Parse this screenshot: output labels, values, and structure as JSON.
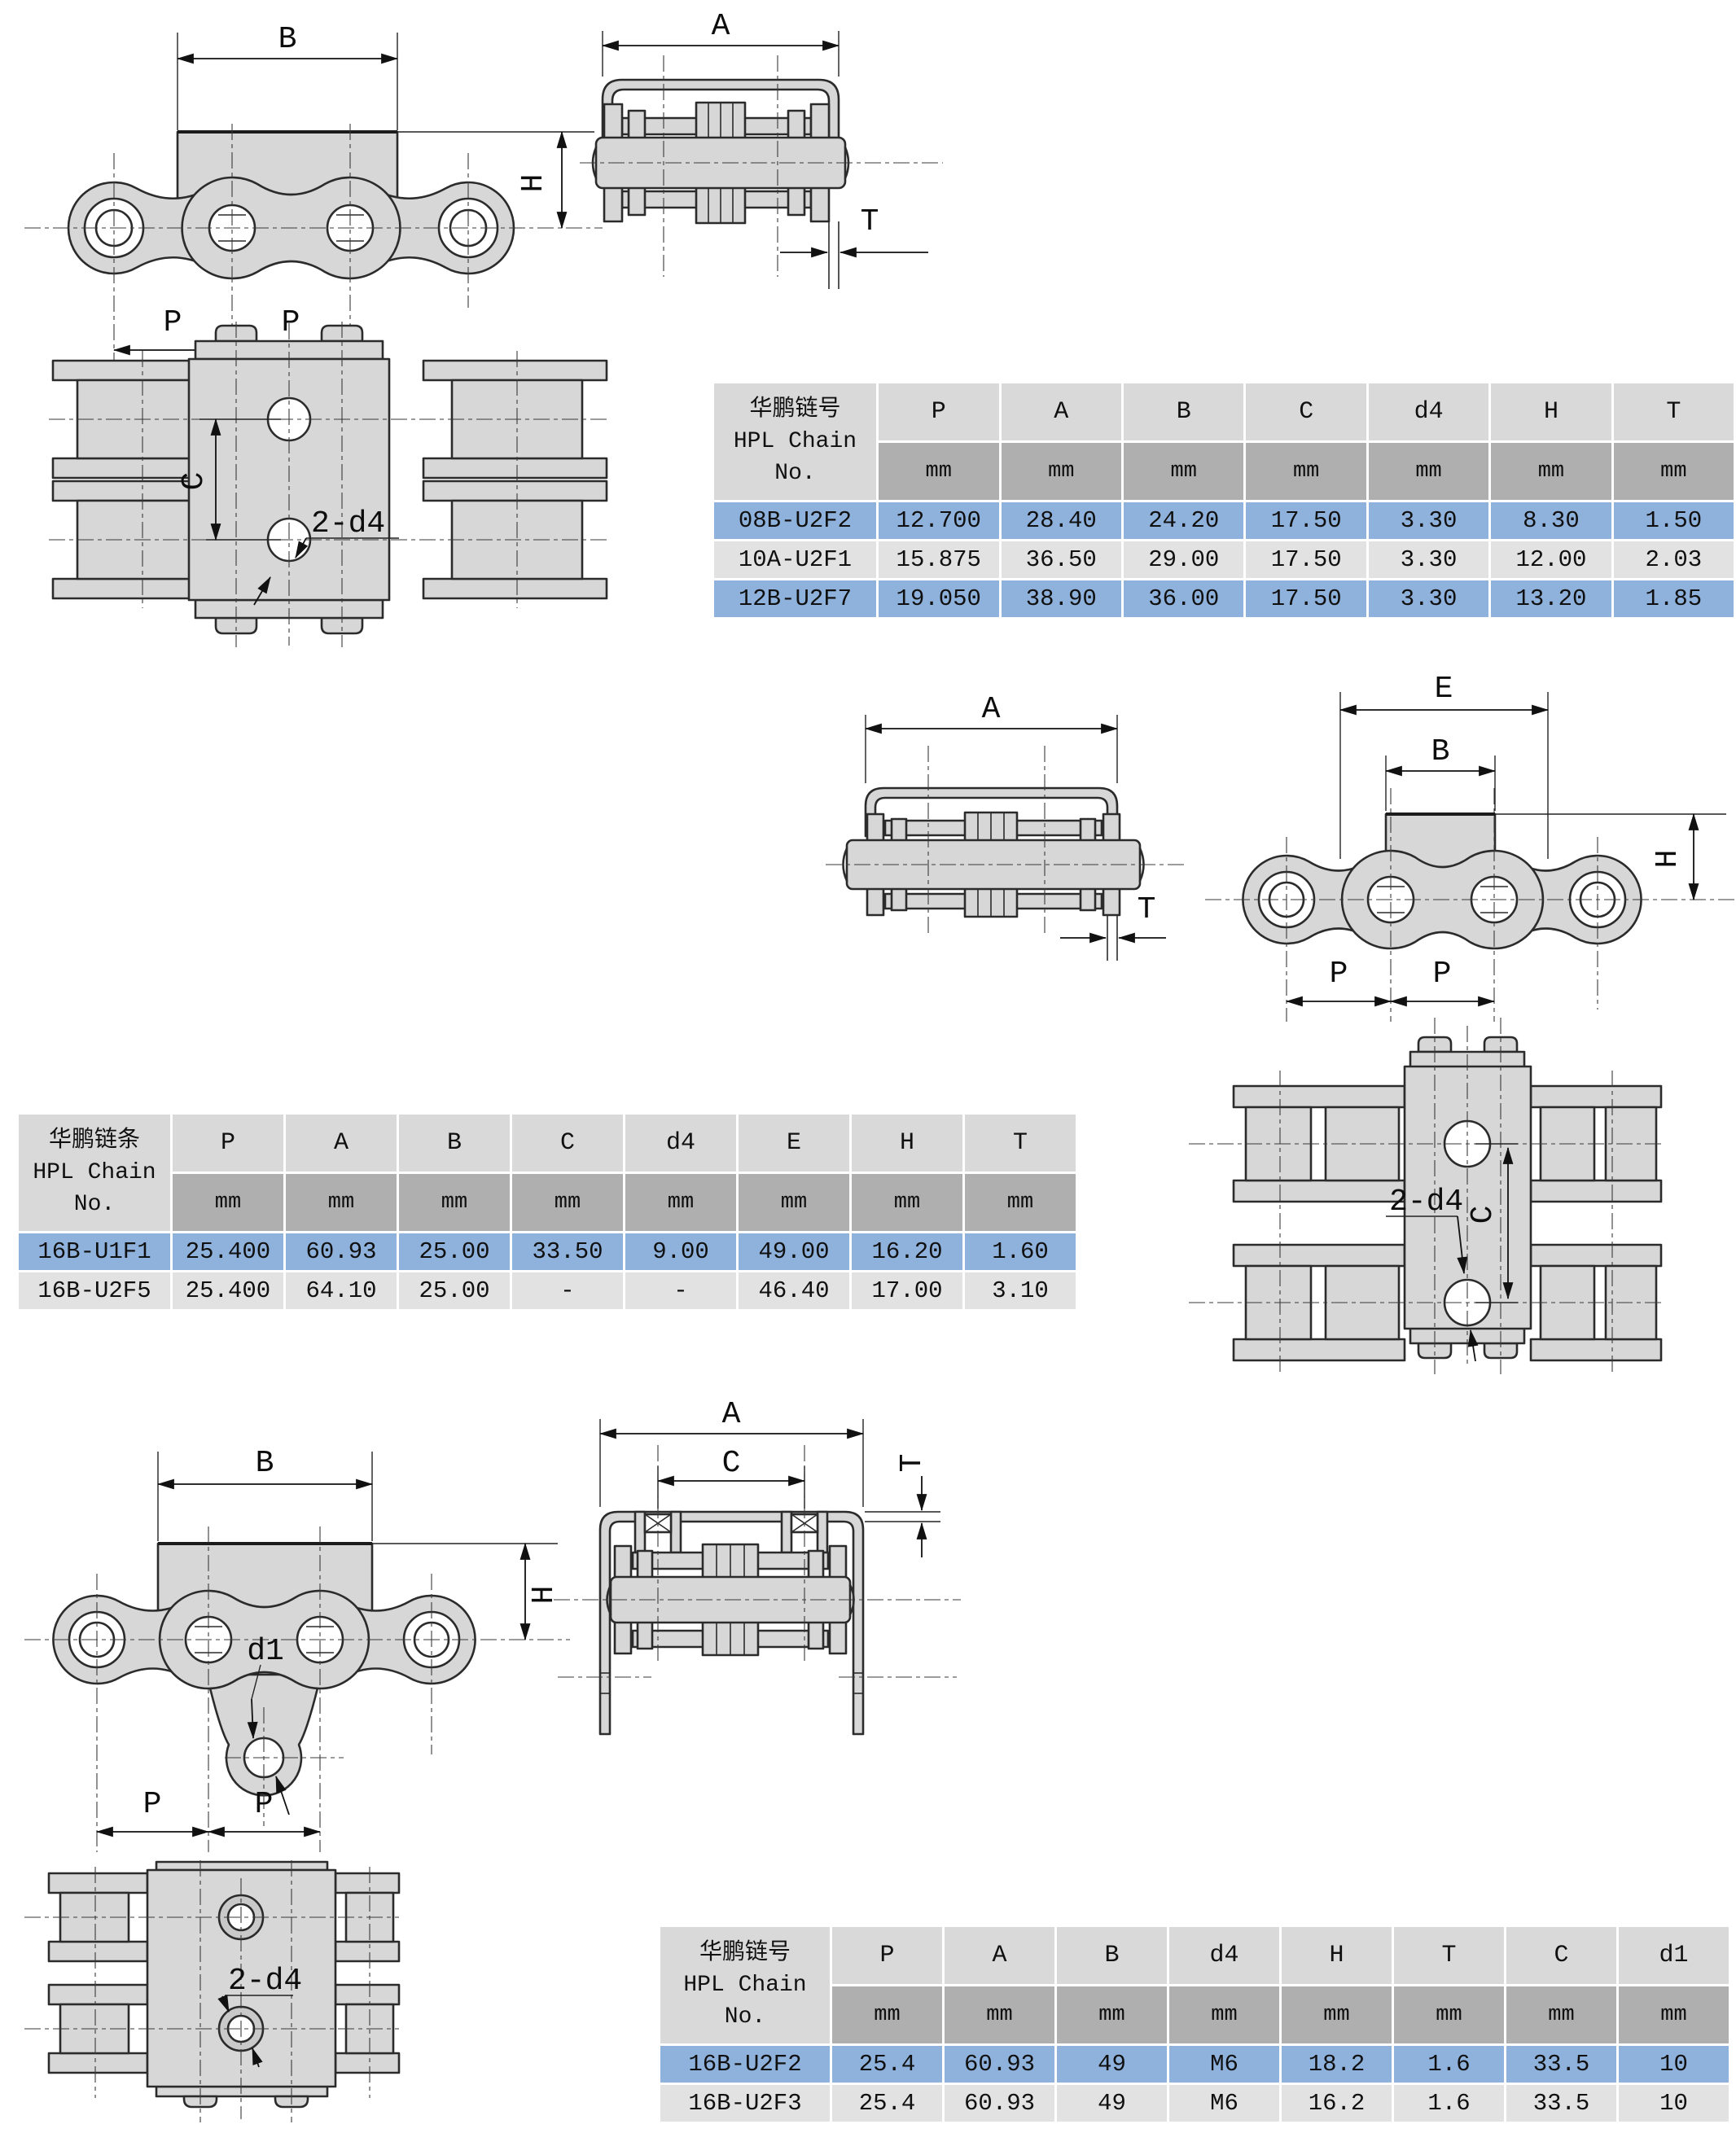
{
  "page": {
    "background": "#ffffff"
  },
  "colors": {
    "metal_fill": "#d7d7d7",
    "outline": "#2b2b2b",
    "table_header_bg": "#d9d9d9",
    "table_unit_bg": "#afafaf",
    "row_highlight_bg": "#8fb2dd",
    "row_normal_bg": "#e2e2e2"
  },
  "diagrams": {
    "top_side": {
      "b": "B",
      "h": "H",
      "p1": "P",
      "p2": "P"
    },
    "top_end": {
      "a": "A",
      "t": "T"
    },
    "top_plan": {
      "c": "C",
      "d4": "2-d4"
    },
    "mid_end": {
      "a": "A",
      "t": "T"
    },
    "mid_side": {
      "e": "E",
      "b": "B",
      "h": "H",
      "p1": "P",
      "p2": "P"
    },
    "mid_plan": {
      "c": "C",
      "d4": "2-d4"
    },
    "bottom_side": {
      "b": "B",
      "h": "H",
      "d1": "d1",
      "p1": "P",
      "p2": "P"
    },
    "bottom_end": {
      "a": "A",
      "c": "C",
      "t": "T"
    },
    "bottom_plan": {
      "d4": "2-d4"
    }
  },
  "tables": {
    "t1": {
      "id": {
        "l1": "华鹏链号",
        "l2": "HPL Chain",
        "l3": "No."
      },
      "columns": [
        "P",
        "A",
        "B",
        "C",
        "d4",
        "H",
        "T"
      ],
      "unit": "mm",
      "rows": [
        {
          "no": "08B-U2F2",
          "highlight": true,
          "values": [
            "12.700",
            "28.40",
            "24.20",
            "17.50",
            "3.30",
            "8.30",
            "1.50"
          ]
        },
        {
          "no": "10A-U2F1",
          "highlight": false,
          "values": [
            "15.875",
            "36.50",
            "29.00",
            "17.50",
            "3.30",
            "12.00",
            "2.03"
          ]
        },
        {
          "no": "12B-U2F7",
          "highlight": true,
          "values": [
            "19.050",
            "38.90",
            "36.00",
            "17.50",
            "3.30",
            "13.20",
            "1.85"
          ]
        }
      ]
    },
    "t2": {
      "id": {
        "l1": "华鹏链条",
        "l2": "HPL Chain",
        "l3": "No."
      },
      "columns": [
        "P",
        "A",
        "B",
        "C",
        "d4",
        "E",
        "H",
        "T"
      ],
      "unit": "mm",
      "rows": [
        {
          "no": "16B-U1F1",
          "highlight": true,
          "values": [
            "25.400",
            "60.93",
            "25.00",
            "33.50",
            "9.00",
            "49.00",
            "16.20",
            "1.60"
          ]
        },
        {
          "no": "16B-U2F5",
          "highlight": false,
          "values": [
            "25.400",
            "64.10",
            "25.00",
            "-",
            "-",
            "46.40",
            "17.00",
            "3.10"
          ]
        }
      ]
    },
    "t3": {
      "id": {
        "l1": "华鹏链号",
        "l2": "HPL Chain",
        "l3": "No."
      },
      "columns": [
        "P",
        "A",
        "B",
        "d4",
        "H",
        "T",
        "C",
        "d1"
      ],
      "unit": "mm",
      "rows": [
        {
          "no": "16B-U2F2",
          "highlight": true,
          "values": [
            "25.4",
            "60.93",
            "49",
            "M6",
            "18.2",
            "1.6",
            "33.5",
            "10"
          ]
        },
        {
          "no": "16B-U2F3",
          "highlight": false,
          "values": [
            "25.4",
            "60.93",
            "49",
            "M6",
            "16.2",
            "1.6",
            "33.5",
            "10"
          ]
        }
      ]
    }
  }
}
